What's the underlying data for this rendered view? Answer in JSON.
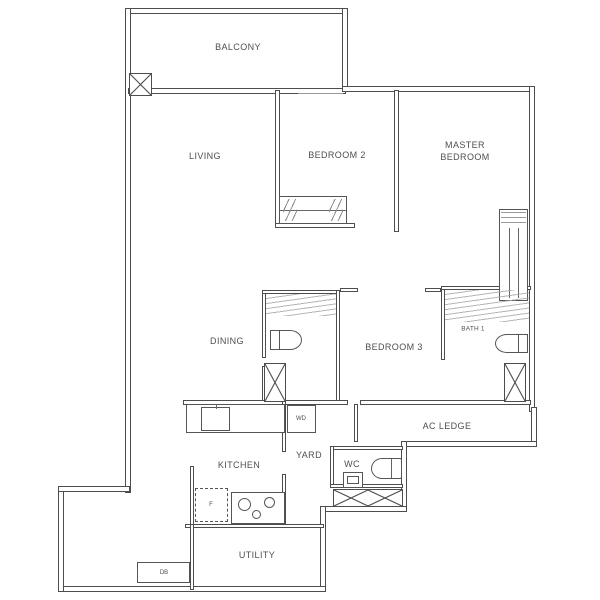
{
  "floor_plan": {
    "labels": {
      "balcony": "BALCONY",
      "living": "LIVING",
      "bedroom2": "BEDROOM 2",
      "master_line1": "MASTER",
      "master_line2": "BEDROOM",
      "dining": "DINING",
      "bedroom3": "BEDROOM 3",
      "bath1": "BATH 1",
      "ac_ledge": "AC LEDGE",
      "kitchen": "KITCHEN",
      "yard": "YARD",
      "wc": "WC",
      "utility": "UTILITY",
      "washer_dryer": "WD",
      "db": "DB",
      "fridge": "F"
    },
    "colors": {
      "wall": "#4d4d4d",
      "background": "#ffffff",
      "label": "#4f4f4f",
      "hatch": "#a3a3a3"
    }
  }
}
